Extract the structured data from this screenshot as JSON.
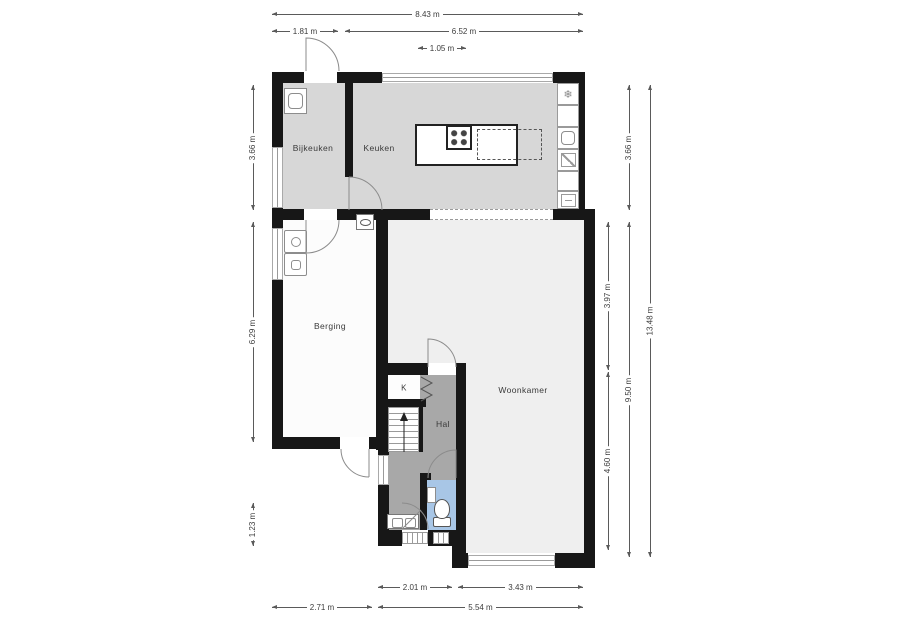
{
  "rooms": {
    "bijkeuken": {
      "label": "Bijkeuken"
    },
    "keuken": {
      "label": "Keuken"
    },
    "berging": {
      "label": "Berging"
    },
    "woonkamer": {
      "label": "Woonkamer"
    },
    "hal": {
      "label": "Hal"
    },
    "kast": {
      "label": "K"
    }
  },
  "dimensions": {
    "top": {
      "total": "8.43 m",
      "left": "1.81 m",
      "right": "6.52 m",
      "island": "1.05 m"
    },
    "left": {
      "top": "3.66 m",
      "middle": "6.29 m",
      "bottom": "1.23 m"
    },
    "right": {
      "living_top": "3.97 m",
      "living_bottom": "4.60 m",
      "kitchen": "3.66 m",
      "lower": "9.50 m",
      "total": "13.48 m"
    },
    "bottom": {
      "hall": "2.01 m",
      "living": "3.43 m",
      "left": "2.71 m",
      "right": "5.54 m"
    }
  },
  "glyphs": {
    "freezer": "❄"
  },
  "icons": {
    "freezer": "snowflake-freezer",
    "kitchen_sink": "kitchen-sink",
    "dishwasher": "dishwasher",
    "oven": "oven",
    "cooktop": "four-burner-cooktop",
    "utility_sink": "utility-sink",
    "washer": "washing-machine",
    "dryer": "dryer",
    "meter_cabinet": "meter-box",
    "toilet": "toilet",
    "toilet_sink": "hand-basin",
    "shoe_cabinet": "hall-cabinet",
    "stairs": "stairs-up"
  },
  "colors": {
    "wall": "#171717",
    "kitchen_floor": "#d7d7d7",
    "living_floor": "#efefef",
    "storage_floor": "#fcfcfc",
    "hall_floor": "#a8a8a8",
    "toilet_floor": "#a8c6e6"
  }
}
